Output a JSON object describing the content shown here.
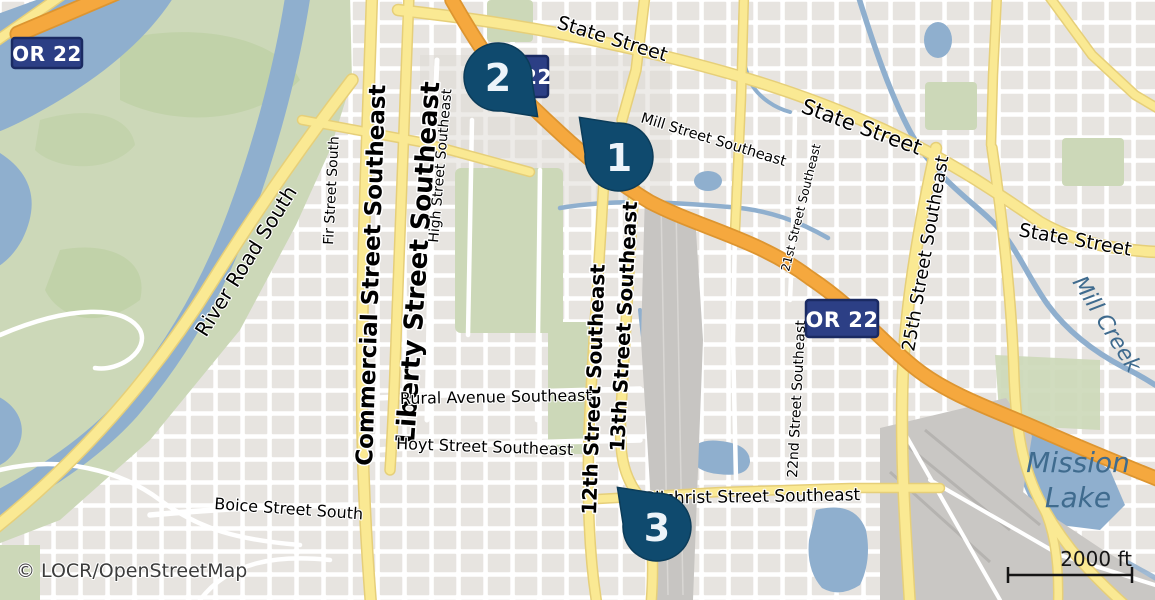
{
  "attribution": {
    "text": "© LOCR/OpenStreetMap"
  },
  "scale_bar": {
    "label": "2000 ft"
  },
  "markers": {
    "m1": {
      "number": "1"
    },
    "m2": {
      "number": "2"
    },
    "m3": {
      "number": "3"
    }
  },
  "shields": {
    "nw": {
      "label": "OR 22"
    },
    "mid": {
      "label": "OR 22"
    },
    "behind": {
      "label": "OR 22"
    }
  },
  "labels": {
    "state1": {
      "text": "State Street"
    },
    "state2": {
      "text": "State Street"
    },
    "state3": {
      "text": "State Street"
    },
    "mill_st": {
      "text": "Mill Street Southeast"
    },
    "commercial": {
      "text": "Commercial Street Southeast"
    },
    "liberty": {
      "text": "Liberty Street Southeast"
    },
    "high": {
      "text": "High Street Southeast"
    },
    "fir": {
      "text": "Fir Street South"
    },
    "river_road": {
      "text": "River Road South"
    },
    "st12": {
      "text": "12th Street Southeast"
    },
    "st13": {
      "text": "13th Street Southeast"
    },
    "st17_hint": {
      "text": ""
    },
    "st21": {
      "text": "21st Street Southeast"
    },
    "st22": {
      "text": "22nd Street Southeast"
    },
    "st25": {
      "text": "25th Street Southeast"
    },
    "rural": {
      "text": "Rural Avenue Southeast"
    },
    "hoyt": {
      "text": "Hoyt Street Southeast"
    },
    "boice": {
      "text": "Boice Street South"
    },
    "gilchrist": {
      "text": "Gilchrist Street Southeast"
    },
    "mill_creek": {
      "text": "Mill Creek"
    },
    "mission1": {
      "text": "Mission"
    },
    "mission2": {
      "text": "Lake"
    }
  },
  "colors": {
    "land": "#f0eeea",
    "block": "#e7e4e0",
    "park": "#ccd8b8",
    "park_dark": "#bdd0a4",
    "water": "#8fafce",
    "water_label": "#3f6b8e",
    "road_yellow": "#fae993",
    "road_yellow_casing": "#e6cf79",
    "road_orange": "#f5a83e",
    "road_orange_casing": "#dd9530",
    "road_white": "#ffffff",
    "rail": "#c7c5c2",
    "rail_track": "#d9d7d4",
    "industrial": "#c9c7c4",
    "marker": "#0f4a6e",
    "marker_stroke": "#0c3c59",
    "marker_text": "#edf4fa",
    "shield_fill": "#2c3f85",
    "shield_border": "#1a2a62",
    "shield_text": "#ffffff",
    "scale": "#151515",
    "attribution_color": "#3c3c3c"
  }
}
